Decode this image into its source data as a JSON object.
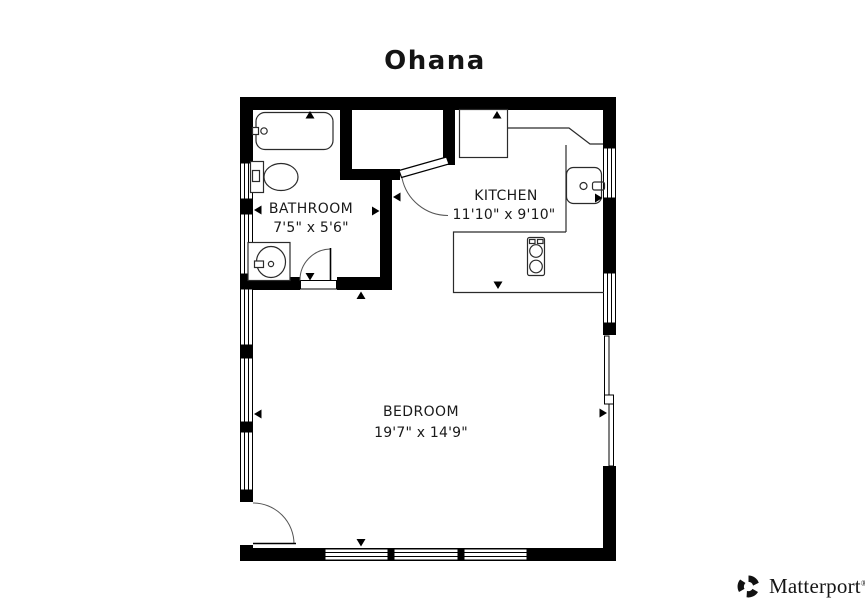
{
  "page": {
    "title": "Ohana",
    "background": "#ffffff"
  },
  "floor_plan": {
    "rooms": {
      "bathroom": {
        "name": "BATHROOM",
        "dimensions": "7'5\" x 5'6\""
      },
      "kitchen": {
        "name": "KITCHEN",
        "dimensions": "11'10\" x 9'10\""
      },
      "bedroom": {
        "name": "BEDROOM",
        "dimensions": "19'7\" x 14'9\""
      }
    },
    "fixtures": [
      "bathtub",
      "toilet",
      "vanity-sink",
      "kitchen-sink",
      "refrigerator",
      "cooktop",
      "counters"
    ],
    "features": [
      "windows",
      "hinged-doors",
      "sliding-glass-door",
      "dimension-arrows"
    ],
    "colors": {
      "wall": "#000000",
      "fixture_line": "#2b2b2b",
      "label_text": "#1a1a1a",
      "background": "#ffffff"
    }
  },
  "branding": {
    "logo_text": "Matterport",
    "trademark_symbol": "®",
    "logo_icon": "matterport-pinwheel-icon"
  }
}
